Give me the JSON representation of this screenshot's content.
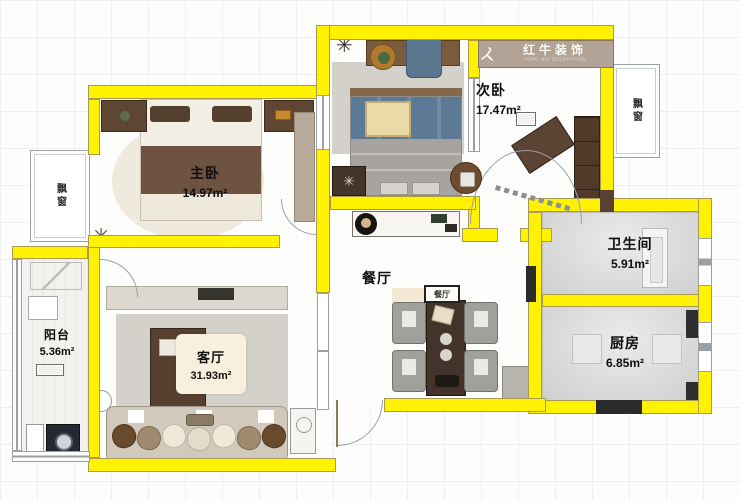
{
  "logo": {
    "brand": "红牛装饰",
    "tagline": "HONG NIU DECORATION"
  },
  "rooms": {
    "master": {
      "label": "主卧",
      "area": "14.97m²"
    },
    "second": {
      "label": "次卧",
      "area": "17.47m²"
    },
    "bath": {
      "label": "卫生间",
      "area": "5.91m²"
    },
    "kitchen": {
      "label": "厨房",
      "area": "6.85m²"
    },
    "dining": {
      "label": "餐厅"
    },
    "living": {
      "label": "客厅",
      "area": "31.93m²"
    },
    "balcony": {
      "label": "阳台",
      "area": "5.36m²"
    }
  },
  "annotations": {
    "bay_window_left": "飘窗",
    "bay_window_right": "飘窗",
    "dining_sign": "餐厅"
  },
  "icons": {
    "plant": "✳"
  },
  "colors": {
    "wall_yellow": "#FFF100",
    "logo_bg": "#B3A396",
    "floor_gray": "#D6D6D6",
    "wood_dark": "#57402F",
    "bedding_blue": "#5C7A95"
  }
}
